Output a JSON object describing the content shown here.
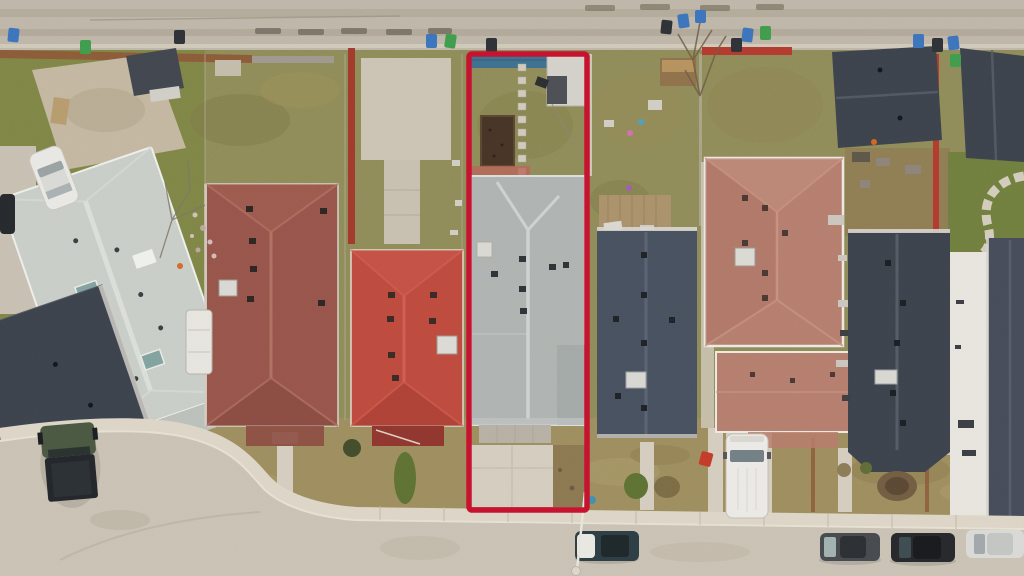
{
  "scene": {
    "type": "aerial-drone-photo",
    "subject": "Top-down aerial view of a residential block; one narrow lot is outlined with a red property boundary (real-estate listing style). Back alley with waste bins at top, curved street with parked cars at bottom."
  },
  "annotations": {
    "highlight": {
      "shape": "rectangle",
      "purpose": "property-boundary-outline",
      "color": "#c5122e"
    }
  },
  "colors": {
    "alley": "#bdb5a7",
    "street": "#c9c1b3",
    "sidewalk": "#dcd5c6",
    "concrete": "#d3ccbe",
    "grassOlive": "#8d8a58",
    "grassGreen": "#78823f",
    "grassTan": "#9c8c5e",
    "dirt": "#8d7852",
    "soil": "#463426",
    "roofHighlight": "#adb2b0",
    "roofRidge": "#ced3d1",
    "roofWhite": "#c7cdc6",
    "roofMaroon": "#95544a",
    "roofRed": "#bc4a3e",
    "roofTerracotta": "#b47c6d",
    "roofBlueGray": "#47505e",
    "roofDark": "#3c424c",
    "outline": "#c5122e",
    "tarp": "#3e6e8e",
    "binBlue": "#3c72bb",
    "binGreen": "#3f9b4c",
    "binBlack": "#2e3236",
    "fenceRust": "#8a5a38",
    "fenceRed": "#b13a2e",
    "vanWhite": "#ebe9e5",
    "truckGreen": "#495741",
    "carDark": "#46494d",
    "carBlack": "#26282c",
    "carWhite": "#d8d8d6",
    "carTeal": "#2c3e44",
    "shrub": "#5d7033"
  },
  "objects": {
    "bins": {
      "blue": 7,
      "green": 4,
      "dark": 5
    },
    "vehicles": [
      {
        "type": "sedan",
        "color": "dark-teal-with-white-cover",
        "location": "bottom-street-center"
      },
      {
        "type": "sedan",
        "color": "gray",
        "location": "bottom-street-right"
      },
      {
        "type": "sedan",
        "color": "black",
        "location": "bottom-street-right"
      },
      {
        "type": "sedan",
        "color": "white",
        "location": "bottom-street-right-edge"
      },
      {
        "type": "van",
        "color": "white",
        "location": "driveway-right"
      },
      {
        "type": "pickup-truck",
        "color": "dark-green",
        "location": "driveway-bottom-left"
      },
      {
        "type": "car",
        "color": "white",
        "location": "top-left-parking"
      },
      {
        "type": "suv",
        "color": "black",
        "location": "left-edge"
      }
    ],
    "highlighted_lot_features": [
      "blue-tarp",
      "storage-shed",
      "stepping-stones",
      "garden-bed",
      "gray-shingle-roof-house",
      "front-driveway"
    ]
  }
}
